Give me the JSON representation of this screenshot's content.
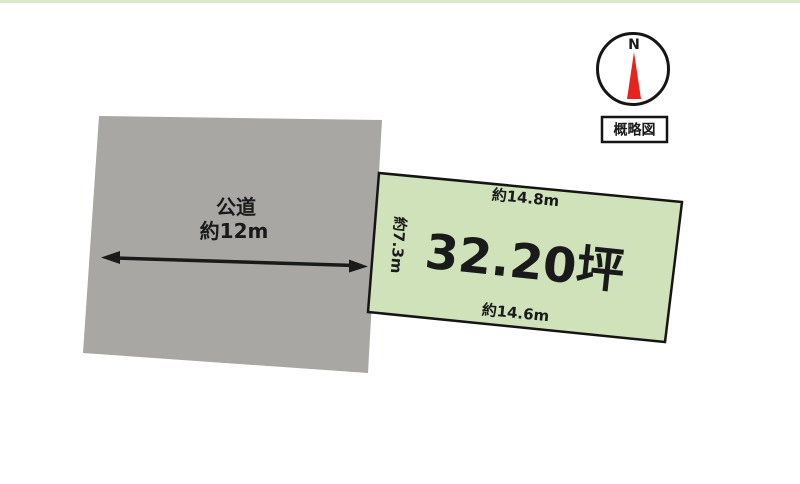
{
  "diagram": {
    "road": {
      "name": "公道",
      "width": "約12m"
    },
    "plot": {
      "area": "32.20坪",
      "top_edge": "約14.8m",
      "bottom_edge": "約14.6m",
      "left_edge": "約7.3m"
    },
    "compass": {
      "north": "N"
    },
    "caption": "概略図"
  },
  "colors": {
    "plot_fill": "#cfe2ba",
    "plot_border": "#151515",
    "road_fill": "#a9a7a4",
    "needle_red": "#e8221c",
    "top_strip": "#d8e8cb",
    "ink": "#1a1a1a"
  }
}
